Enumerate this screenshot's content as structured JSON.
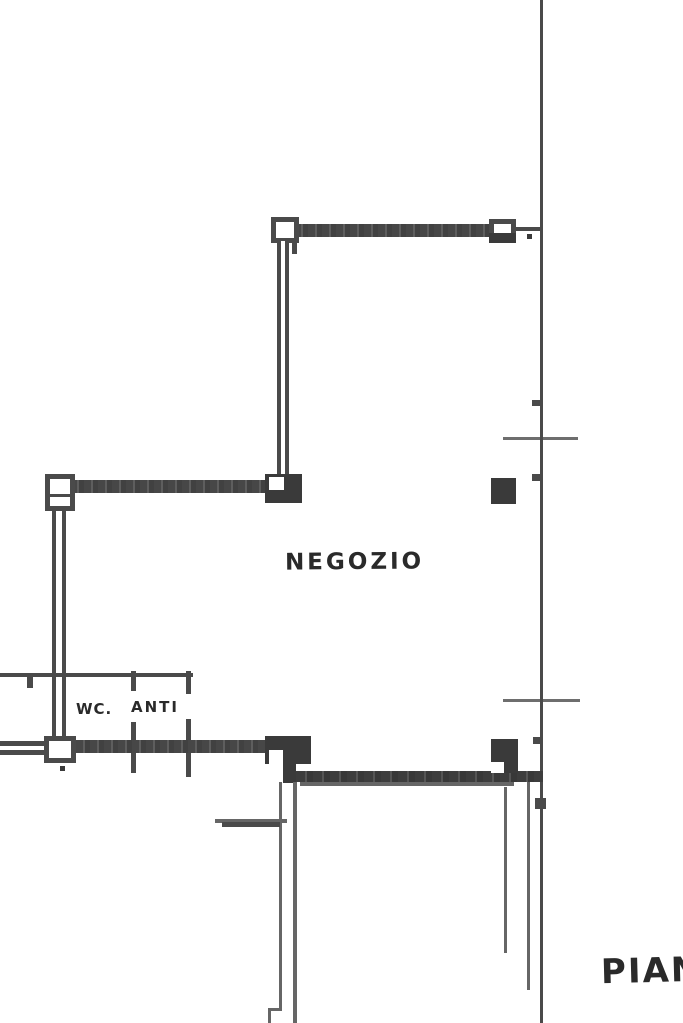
{
  "labels": {
    "negozio": "NEGOZIO",
    "wc": "WC.",
    "anti": "ANTI",
    "caption_partial": "PIAN"
  },
  "colors": {
    "ink": "#4a4a4a",
    "ink_dark": "#3a3a3a",
    "ink_light": "#666666",
    "paper": "#ffffff",
    "text": "#2a2a2a"
  }
}
